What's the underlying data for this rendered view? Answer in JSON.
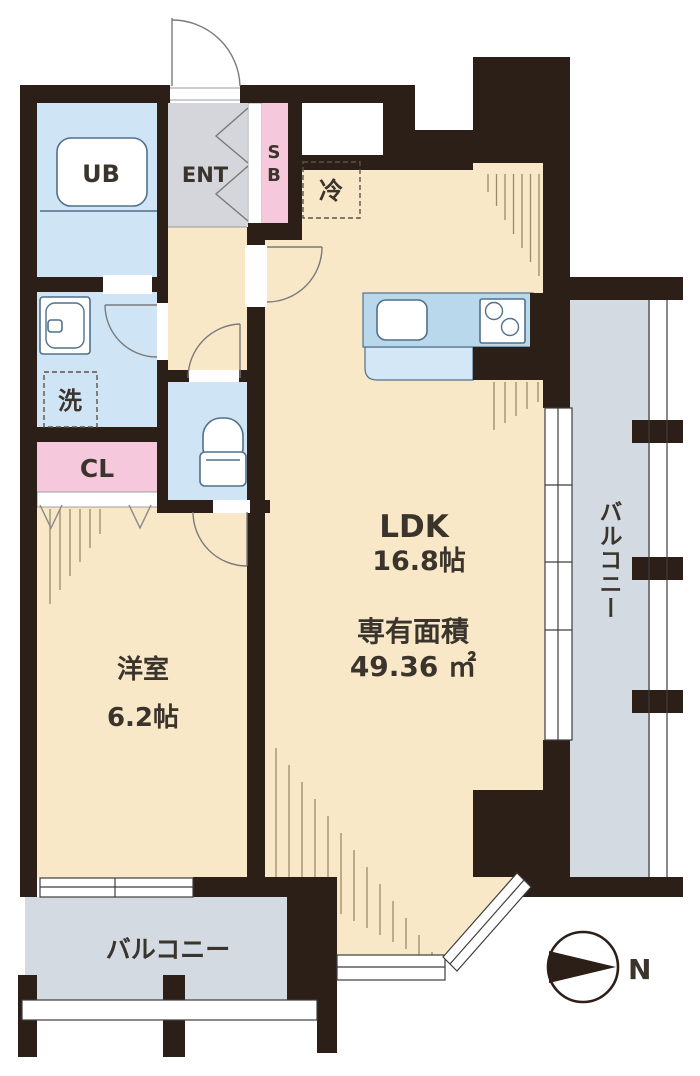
{
  "title": "apartment-floor-plan",
  "labels": {
    "unit_bath": "UB",
    "entrance": "ENT",
    "shoe_box": "SB",
    "refrigerator": "冷",
    "washer": "洗",
    "closet": "CL",
    "ldk_name": "LDK",
    "ldk_size": "16.8帖",
    "area_title": "専有面積",
    "area_value": "49.36 ㎡",
    "western_room_name": "洋室",
    "western_room_size": "6.2帖",
    "balcony_right": "バルコニー",
    "balcony_bottom": "バルコニー",
    "north": "N"
  },
  "colors": {
    "wall": "#2b1f17",
    "beige": "#f8e8c8",
    "blue": "#cfe4f4",
    "kitchen_top": "#b9d8ec",
    "kitchen_low": "#d3e7f6",
    "pink": "#f5c9db",
    "entgray": "#d4d6db",
    "balcony": "#d3dae2",
    "hatch": "#9b8a66",
    "text": "#3a342c"
  }
}
